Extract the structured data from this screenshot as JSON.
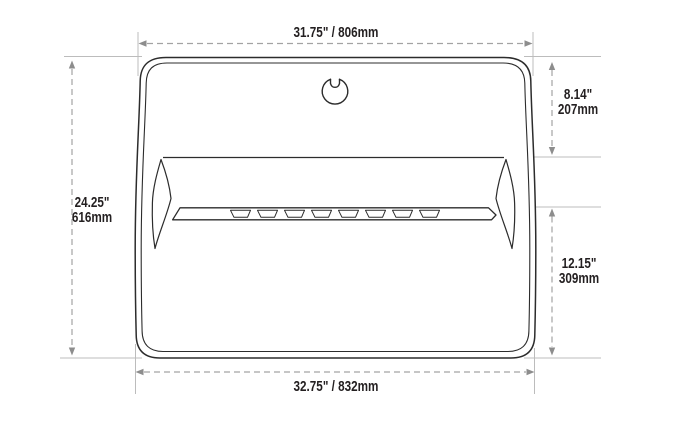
{
  "diagram": {
    "type": "technical-dimension-drawing",
    "dims": {
      "top": "31.75\" / 806mm",
      "bottom": "32.75\" / 832mm",
      "left_in": "24.25\"",
      "left_mm": "616mm",
      "right_upper_in": "8.14\"",
      "right_upper_mm": "207mm",
      "right_lower_in": "12.15\"",
      "right_lower_mm": "309mm"
    },
    "icons": {
      "latch": "lock-cylinder-icon"
    },
    "colors": {
      "outline": "#2c2c2c",
      "dimension_line": "#a3a3a3",
      "extension_line": "#bcbcbc",
      "arrow": "#8d8d8d",
      "label_text": "#231f20",
      "background": "#ffffff"
    }
  }
}
